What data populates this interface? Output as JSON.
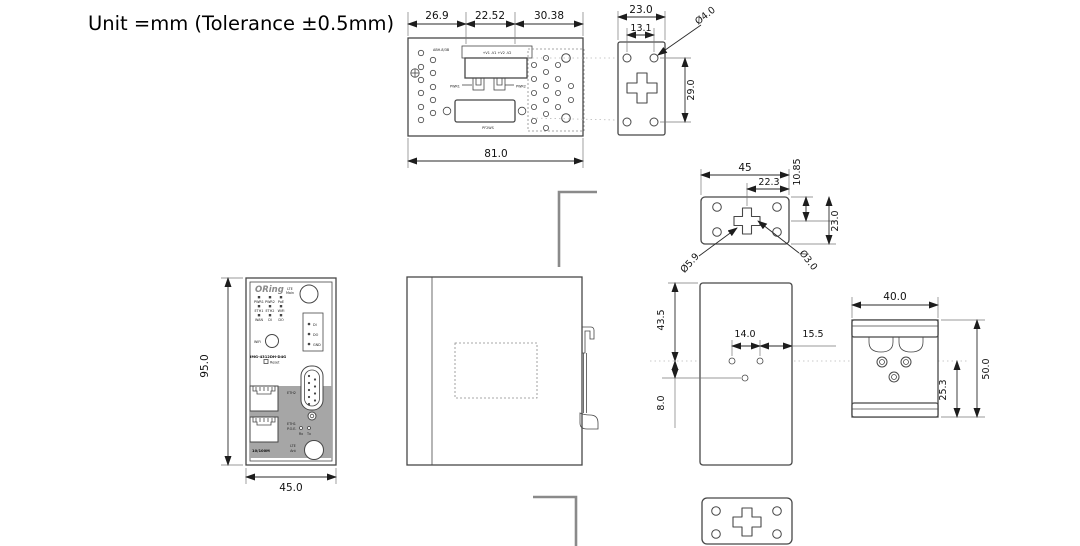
{
  "title": "Unit =mm (Tolerance ±0.5mm)",
  "colors": {
    "line": "#474747",
    "dim": "#2a2a2a",
    "panel_gray": "#a6a6a6",
    "bracket_gray": "#8a8a8a"
  },
  "top_view": {
    "dim_a": "26.9",
    "dim_b": "22.52",
    "dim_c": "30.38",
    "dim_width": "81.0",
    "label_left": "ABH-8/3B",
    "label_terminals": "+V1 -V1 +V2 -V2",
    "label_pwr1": "PWR1",
    "label_pwr2": "PWR2",
    "label_serial": "PF2WS"
  },
  "top_bracket": {
    "dim_width": "23.0",
    "dim_inner": "13.1",
    "dim_hole": "Ø4.0",
    "dim_height": "29.0"
  },
  "mid_plate": {
    "dim_width": "45",
    "dim_inner": "22.3",
    "dim_offset": "10.85",
    "dim_height": "23.0",
    "dim_hole_large": "Ø5.9",
    "dim_hole_small": "Ø3.0"
  },
  "front_view": {
    "dim_height": "95.0",
    "dim_width": "45.0",
    "brand": "ORing",
    "ant_line1": "LTE",
    "ant_line2": "Main",
    "led_labels": [
      "PWR1",
      "PWR2",
      "PoE",
      "ETH1",
      "ETH2",
      "WiFi",
      "WAN",
      "DI",
      "DO"
    ],
    "pin_labels": [
      "DI",
      "DO",
      "GND"
    ],
    "wifi_button": "WiFi",
    "model": "IMG-4312DH-D4G",
    "reset": "Reset",
    "port1": "ETH2",
    "port2_line1": "ETH1",
    "port2_line2": "P.O.E.",
    "rx": "Rx",
    "tx": "Tx",
    "speed": "10/100M",
    "ant_bottom_line1": "LTE",
    "ant_bottom_line2": "Ant"
  },
  "back_view": {
    "dim_top": "43.5",
    "dim_offset": "8.0",
    "dim_spacing": "14.0",
    "dim_edge": "15.5"
  },
  "din_clip": {
    "dim_width": "40.0",
    "dim_height": "50.0",
    "dim_offset": "25.3"
  }
}
